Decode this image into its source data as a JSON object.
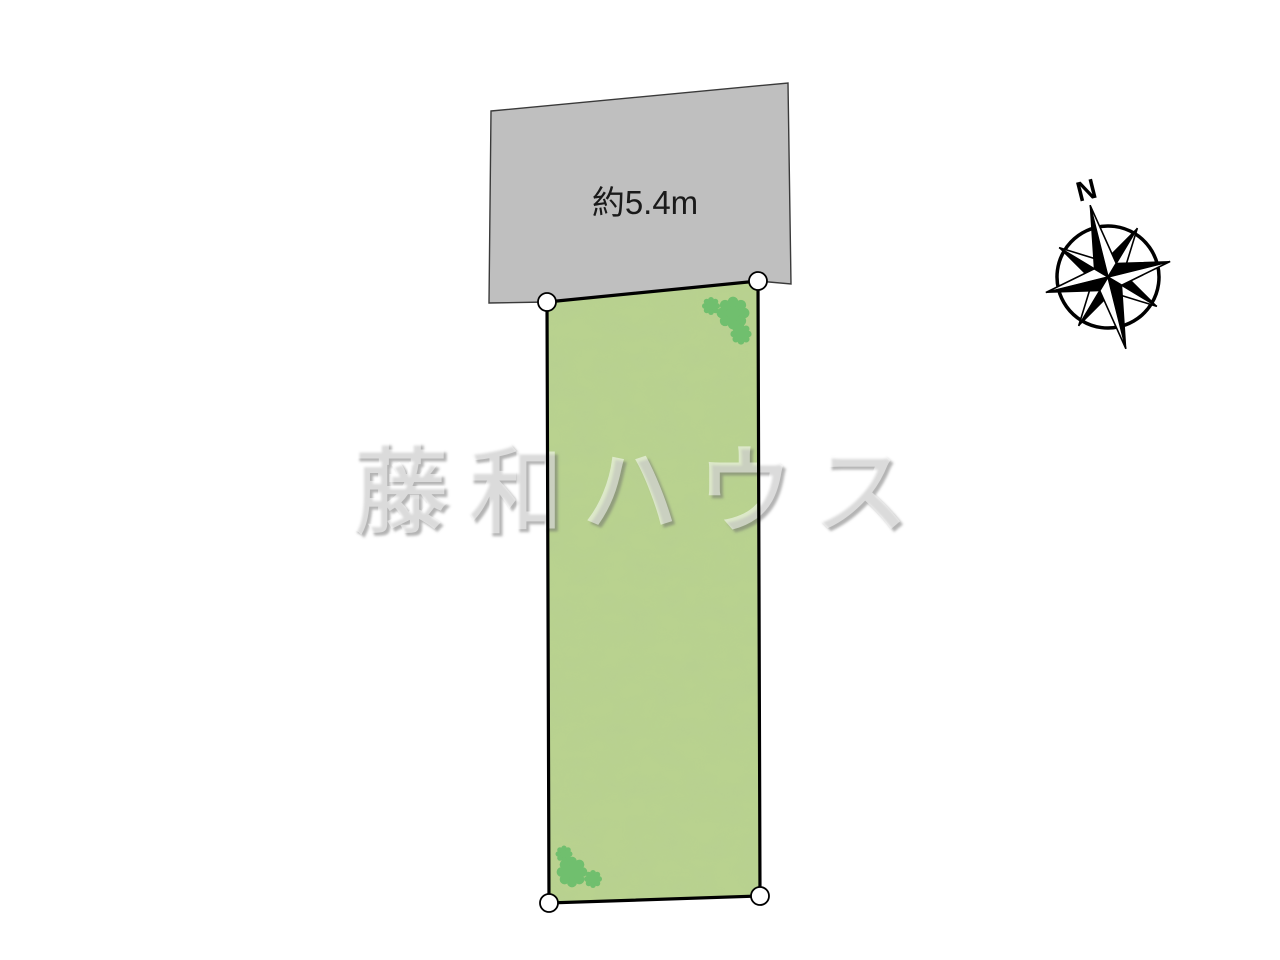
{
  "road": {
    "label": "約5.4m"
  },
  "watermark": {
    "text": "藤和ハウス"
  },
  "compass": {
    "north_label": "N"
  },
  "icons": {
    "compass": "compass-rose-icon",
    "bush": "bush-icon",
    "corner_marker": "corner-marker-dot"
  },
  "colors": {
    "canvas_bg": "#ffffff",
    "road_fill": "#bfbfbf",
    "road_line": "#3a3a3a",
    "plot_fill": "#b9d28f",
    "plot_texture": "#73994d",
    "bush_fill": "#70bf6e",
    "line": "#000000",
    "marker_fill": "#ffffff",
    "text": "#1a1a1a",
    "watermark_fill": "#ffffff"
  }
}
